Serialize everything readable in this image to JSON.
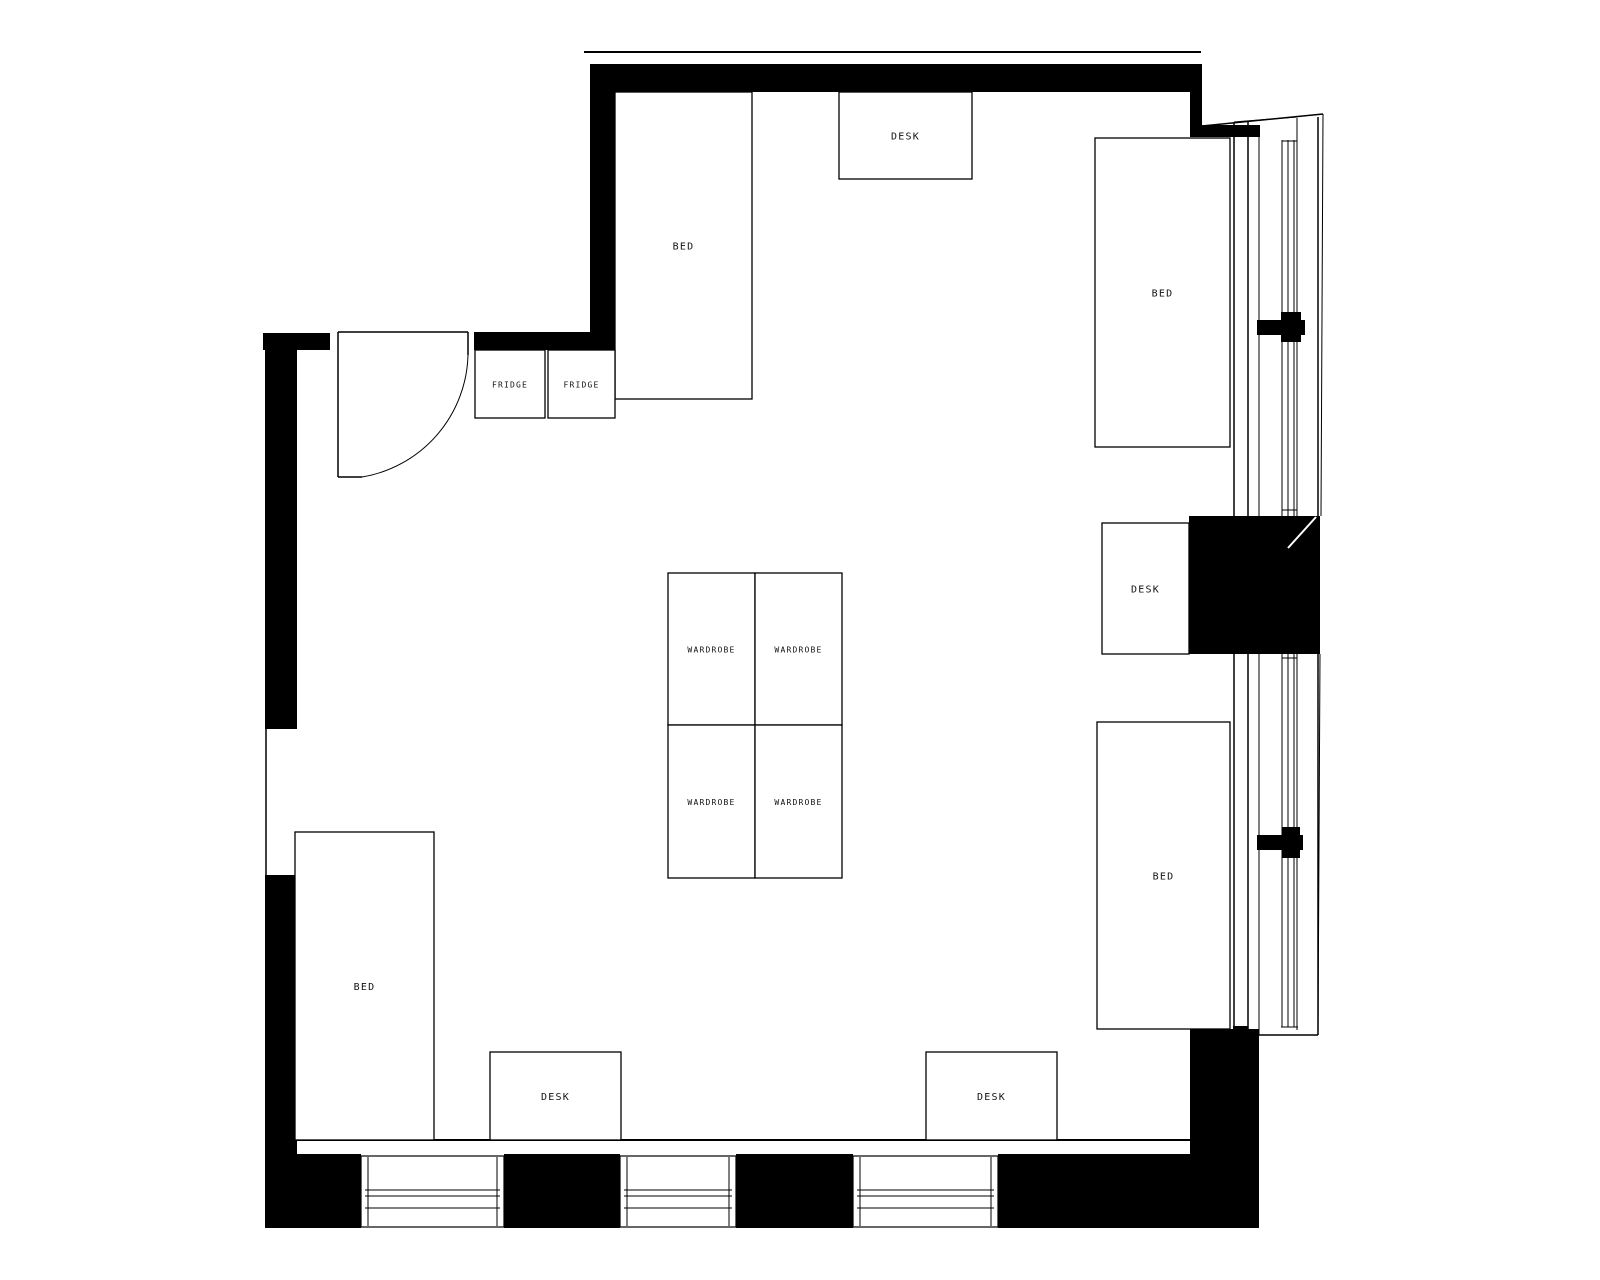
{
  "plan": {
    "title": "dorm-room-floor-plan",
    "canvas": {
      "width": 1600,
      "height": 1280,
      "background": "#ffffff"
    },
    "colors": {
      "wall": "#000000",
      "line": "#000000",
      "label": "#111111",
      "glass_gap": "#ffffff"
    },
    "labels": {
      "bed": "BED",
      "desk": "DESK",
      "fridge": "FRIDGE",
      "wardrobe": "WARDROBE"
    },
    "walls": [
      {
        "name": "top-wall",
        "x": 590,
        "y": 64,
        "w": 600,
        "h": 28
      },
      {
        "name": "top-left-corner-wall",
        "x": 590,
        "y": 92,
        "w": 25,
        "h": 241
      },
      {
        "name": "entry-right-wall",
        "x": 474,
        "y": 332,
        "w": 141,
        "h": 18
      },
      {
        "name": "entry-left-stub-wall",
        "x": 263,
        "y": 333,
        "w": 67,
        "h": 17
      },
      {
        "name": "left-wall-upper",
        "x": 265,
        "y": 333,
        "w": 32,
        "h": 396
      },
      {
        "name": "left-wall-lower",
        "x": 265,
        "y": 875,
        "w": 32,
        "h": 353
      },
      {
        "name": "bottom-wall-seg1",
        "x": 265,
        "y": 1154,
        "w": 96,
        "h": 74
      },
      {
        "name": "bottom-wall-seg2",
        "x": 504,
        "y": 1154,
        "w": 116,
        "h": 74
      },
      {
        "name": "bottom-wall-seg3",
        "x": 736,
        "y": 1154,
        "w": 117,
        "h": 74
      },
      {
        "name": "bottom-wall-seg4",
        "x": 998,
        "y": 1154,
        "w": 192,
        "h": 74
      },
      {
        "name": "right-wall-lower",
        "x": 1190,
        "y": 1029,
        "w": 69,
        "h": 199
      },
      {
        "name": "window-pier-block",
        "x": 1189,
        "y": 516,
        "w": 131,
        "h": 138
      },
      {
        "name": "top-right-step-vertical",
        "x": 1190,
        "y": 64,
        "w": 12,
        "h": 73
      },
      {
        "name": "top-right-step-horizontal",
        "x": 1202,
        "y": 125,
        "w": 58,
        "h": 12
      },
      {
        "name": "bed3-corner-cap",
        "x": 1233,
        "y": 1026,
        "w": 15,
        "h": 8
      }
    ],
    "lines": [
      {
        "name": "top-outer-edge-line",
        "x1": 584,
        "y1": 52,
        "x2": 1201,
        "y2": 52,
        "w": 2
      },
      {
        "name": "floor-inner-edge-line",
        "x1": 297,
        "y1": 1140,
        "x2": 1190,
        "y2": 1140,
        "w": 2
      },
      {
        "name": "left-opening-line",
        "x1": 266,
        "y1": 729,
        "x2": 266,
        "y2": 875,
        "w": 1.5
      },
      {
        "name": "window-line-a-top",
        "x1": 1234,
        "y1": 122,
        "x2": 1234,
        "y2": 516,
        "w": 1.5
      },
      {
        "name": "window-line-a-bottom",
        "x1": 1234,
        "y1": 654,
        "x2": 1234,
        "y2": 1029,
        "w": 1.5
      },
      {
        "name": "window-line-b-top",
        "x1": 1248,
        "y1": 122,
        "x2": 1248,
        "y2": 516,
        "w": 1.5
      },
      {
        "name": "window-line-b-bottom",
        "x1": 1248,
        "y1": 654,
        "x2": 1248,
        "y2": 1031,
        "w": 1.5
      },
      {
        "name": "window-line-c-top",
        "x1": 1259,
        "y1": 125,
        "x2": 1259,
        "y2": 516,
        "w": 1
      },
      {
        "name": "window-line-c-bottom",
        "x1": 1259,
        "y1": 654,
        "x2": 1259,
        "y2": 1035,
        "w": 1
      },
      {
        "name": "window-line-d-top",
        "x1": 1282,
        "y1": 140,
        "x2": 1282,
        "y2": 516,
        "w": 1
      },
      {
        "name": "window-line-d-bottom",
        "x1": 1282,
        "y1": 654,
        "x2": 1282,
        "y2": 1027,
        "w": 1
      },
      {
        "name": "window-line-e-top",
        "x1": 1288,
        "y1": 140,
        "x2": 1288,
        "y2": 516,
        "w": 1
      },
      {
        "name": "window-line-e-bottom",
        "x1": 1288,
        "y1": 654,
        "x2": 1288,
        "y2": 1027,
        "w": 1
      },
      {
        "name": "window-line-f-top",
        "x1": 1294,
        "y1": 140,
        "x2": 1294,
        "y2": 516,
        "w": 1
      },
      {
        "name": "window-line-f-bottom",
        "x1": 1294,
        "y1": 654,
        "x2": 1294,
        "y2": 1027,
        "w": 1
      },
      {
        "name": "window-line-g-top",
        "x1": 1297,
        "y1": 118,
        "x2": 1297,
        "y2": 516,
        "w": 1
      },
      {
        "name": "window-line-g-bottom",
        "x1": 1297,
        "y1": 654,
        "x2": 1297,
        "y2": 1030,
        "w": 1
      },
      {
        "name": "window-outer-line-top",
        "x1": 1318,
        "y1": 117,
        "x2": 1318,
        "y2": 516,
        "w": 1.5
      },
      {
        "name": "window-outer-line-bottom",
        "x1": 1318,
        "y1": 654,
        "x2": 1318,
        "y2": 1035,
        "w": 1.5
      },
      {
        "name": "window-outer-slant-top",
        "x1": 1323,
        "y1": 114,
        "x2": 1321,
        "y2": 516,
        "w": 1
      },
      {
        "name": "window-outer-slant-bottom",
        "x1": 1320,
        "y1": 654,
        "x2": 1318,
        "y2": 1035,
        "w": 1
      },
      {
        "name": "window-head-slant-1",
        "x1": 1202,
        "y1": 126,
        "x2": 1323,
        "y2": 114,
        "w": 1.5
      },
      {
        "name": "window-head-slant-2",
        "x1": 1234,
        "y1": 122,
        "x2": 1297,
        "y2": 117,
        "w": 1
      },
      {
        "name": "window-tick-top",
        "x1": 1282,
        "y1": 141,
        "x2": 1297,
        "y2": 141,
        "w": 1
      },
      {
        "name": "window-tick-above-pier",
        "x1": 1282,
        "y1": 510,
        "x2": 1297,
        "y2": 510,
        "w": 1
      },
      {
        "name": "window-tick-below-pier",
        "x1": 1282,
        "y1": 658,
        "x2": 1297,
        "y2": 658,
        "w": 1
      },
      {
        "name": "window-tick-bottom-1",
        "x1": 1281,
        "y1": 1027,
        "x2": 1298,
        "y2": 1027,
        "w": 1
      },
      {
        "name": "window-sill-bottom",
        "x1": 1259,
        "y1": 1035,
        "x2": 1318,
        "y2": 1035,
        "w": 1.5
      }
    ],
    "door": {
      "name": "entry-door",
      "head": {
        "x1": 338,
        "y1": 332,
        "x2": 468,
        "y2": 332
      },
      "leaf": {
        "x1": 338,
        "y1": 332,
        "x2": 338,
        "y2": 477
      },
      "foot": {
        "x1": 338,
        "y1": 477,
        "x2": 362,
        "y2": 477
      },
      "jamb": {
        "x1": 468,
        "y1": 332,
        "x2": 468,
        "y2": 355
      },
      "arc_path": "M 468 355 A 127 127 0 0 1 362 477"
    },
    "bed4_rail": {
      "name": "bed-side-rail",
      "x": 296,
      "y": 933,
      "w": 12,
      "h": 172
    },
    "furniture": [
      {
        "name": "bed-top-left",
        "label_key": "bed",
        "x": 615,
        "y": 92,
        "w": 137,
        "h": 307,
        "fs": 10
      },
      {
        "name": "desk-top-center",
        "label_key": "desk",
        "x": 839,
        "y": 92,
        "w": 133,
        "h": 87,
        "fs": 10
      },
      {
        "name": "fridge-1",
        "label_key": "fridge",
        "x": 475,
        "y": 350,
        "w": 70,
        "h": 68,
        "fs": 8
      },
      {
        "name": "fridge-2",
        "label_key": "fridge",
        "x": 548,
        "y": 350,
        "w": 67,
        "h": 68,
        "fs": 8
      },
      {
        "name": "wardrobe-1",
        "label_key": "wardrobe",
        "x": 668,
        "y": 573,
        "w": 87,
        "h": 152,
        "fs": 8
      },
      {
        "name": "wardrobe-2",
        "label_key": "wardrobe",
        "x": 755,
        "y": 573,
        "w": 87,
        "h": 152,
        "fs": 8
      },
      {
        "name": "wardrobe-3",
        "label_key": "wardrobe",
        "x": 668,
        "y": 725,
        "w": 87,
        "h": 153,
        "fs": 8
      },
      {
        "name": "wardrobe-4",
        "label_key": "wardrobe",
        "x": 755,
        "y": 725,
        "w": 87,
        "h": 153,
        "fs": 8
      },
      {
        "name": "bed-top-right",
        "label_key": "bed",
        "x": 1095,
        "y": 138,
        "w": 135,
        "h": 309,
        "fs": 10
      },
      {
        "name": "desk-right",
        "label_key": "desk",
        "x": 1102,
        "y": 523,
        "w": 87,
        "h": 131,
        "fs": 10
      },
      {
        "name": "bed-bottom-right",
        "label_key": "bed",
        "x": 1097,
        "y": 722,
        "w": 133,
        "h": 307,
        "fs": 10
      },
      {
        "name": "bed-bottom-left",
        "label_key": "bed",
        "x": 295,
        "y": 832,
        "w": 139,
        "h": 308,
        "fs": 10
      },
      {
        "name": "desk-bottom-left",
        "label_key": "desk",
        "x": 490,
        "y": 1052,
        "w": 131,
        "h": 88,
        "fs": 10
      },
      {
        "name": "desk-bottom-right",
        "label_key": "desk",
        "x": 926,
        "y": 1052,
        "w": 131,
        "h": 88,
        "fs": 10
      }
    ],
    "bottom_windows": [
      {
        "name": "bottom-window-1",
        "x": 361,
        "y": 1156,
        "w": 143,
        "h": 71
      },
      {
        "name": "bottom-window-2",
        "x": 620,
        "y": 1156,
        "w": 116,
        "h": 71
      },
      {
        "name": "bottom-window-3",
        "x": 853,
        "y": 1156,
        "w": 145,
        "h": 71
      }
    ],
    "bottom_window_glazing": {
      "line_y": [
        1190,
        1196,
        1208
      ],
      "jamb_inset": 7,
      "line_inset": 4
    },
    "mullion_crosses": [
      {
        "name": "window-mullion-cross-1",
        "rects": [
          [
            1257,
            320,
            48,
            15
          ],
          [
            1281,
            312,
            20,
            30
          ]
        ]
      },
      {
        "name": "window-mullion-cross-2",
        "rects": [
          [
            1257,
            835,
            46,
            15
          ],
          [
            1282,
            827,
            18,
            31
          ]
        ]
      }
    ],
    "pier_diagonal": {
      "name": "pier-diagonal-mark",
      "x1": 1288,
      "y1": 548,
      "x2": 1316,
      "y2": 517,
      "w": 2,
      "color": "#ffffff"
    }
  }
}
